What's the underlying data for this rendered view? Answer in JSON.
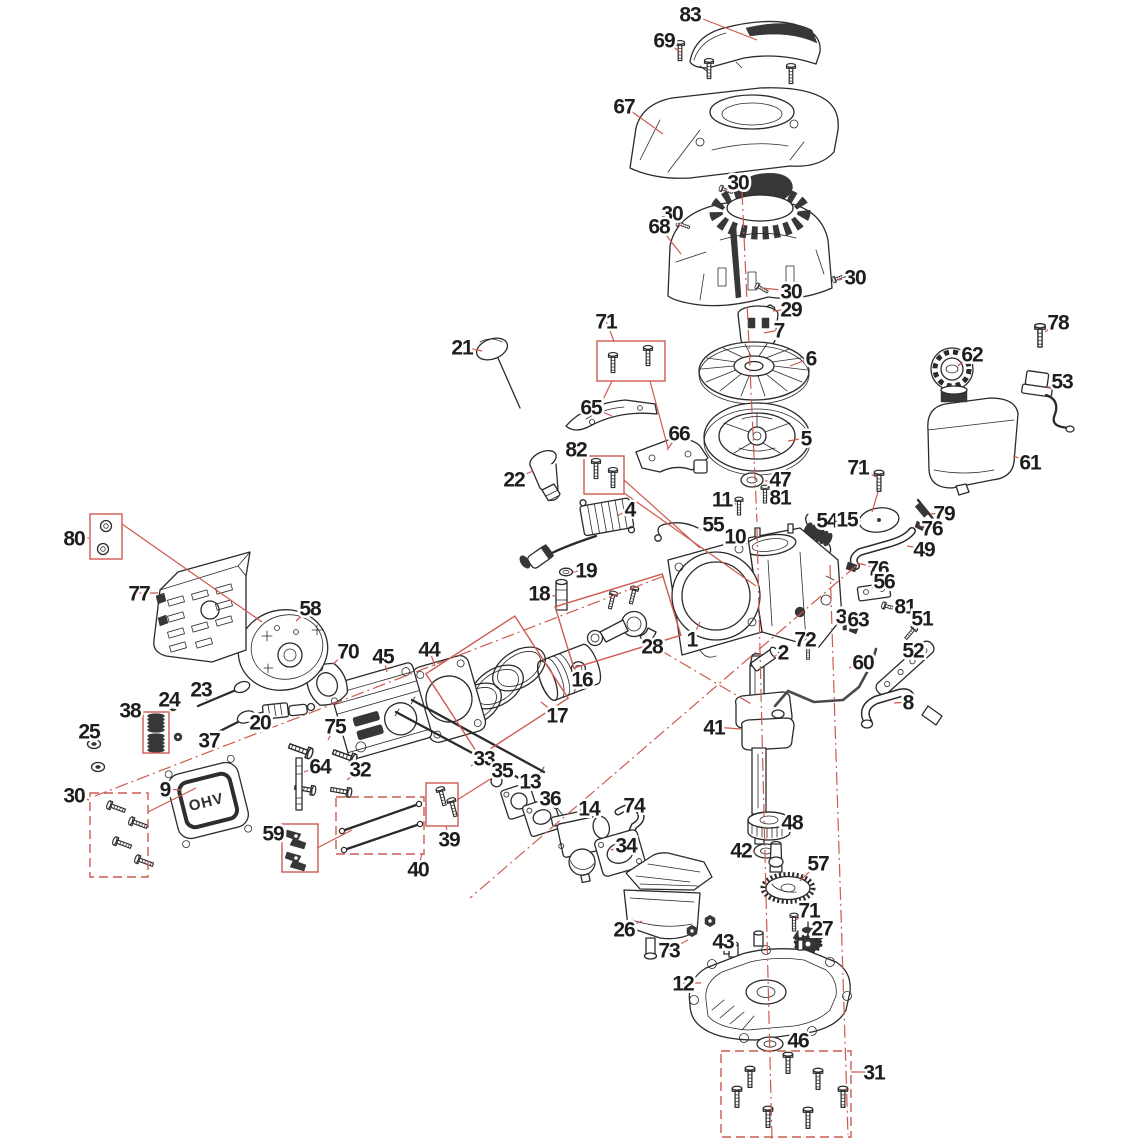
{
  "diagram": {
    "type": "exploded-parts-diagram",
    "subject": "small OHV engine exploded view",
    "background": "#ffffff",
    "colors": {
      "red": "#cd5a50",
      "ink": "#1e1e1e"
    },
    "ohv_label": "OHV",
    "callouts": [
      {
        "n": "83",
        "x": 690,
        "y": 14,
        "tx": 757,
        "ty": 40
      },
      {
        "n": "69",
        "x": 664,
        "y": 40,
        "tx": 680,
        "ty": 52
      },
      {
        "n": "67",
        "x": 624,
        "y": 106,
        "tx": 663,
        "ty": 134
      },
      {
        "n": "30",
        "x": 738,
        "y": 182,
        "tx": 725,
        "ty": 191
      },
      {
        "n": "30",
        "x": 672,
        "y": 213,
        "tx": 680,
        "ty": 226
      },
      {
        "n": "68",
        "x": 659,
        "y": 226,
        "tx": 681,
        "ty": 254
      },
      {
        "n": "30",
        "x": 855,
        "y": 277,
        "tx": 838,
        "ty": 280
      },
      {
        "n": "30",
        "x": 791,
        "y": 291,
        "tx": 762,
        "ty": 288
      },
      {
        "n": "29",
        "x": 791,
        "y": 309,
        "tx": 773,
        "ty": 311
      },
      {
        "n": "71",
        "x": 606,
        "y": 321,
        "tx": 614,
        "ty": 341
      },
      {
        "n": "7",
        "x": 779,
        "y": 330,
        "tx": 764,
        "ty": 333
      },
      {
        "n": "6",
        "x": 811,
        "y": 358,
        "tx": 790,
        "ty": 366
      },
      {
        "n": "78",
        "x": 1058,
        "y": 322,
        "tx": 1045,
        "ty": 332
      },
      {
        "n": "62",
        "x": 972,
        "y": 354,
        "tx": 958,
        "ty": 366
      },
      {
        "n": "53",
        "x": 1062,
        "y": 381,
        "tx": 1047,
        "ty": 388
      },
      {
        "n": "21",
        "x": 462,
        "y": 347,
        "tx": 482,
        "ty": 351
      },
      {
        "n": "65",
        "x": 591,
        "y": 407,
        "tx": 612,
        "ty": 416
      },
      {
        "n": "66",
        "x": 679,
        "y": 433,
        "tx": 667,
        "ty": 450
      },
      {
        "n": "5",
        "x": 806,
        "y": 438,
        "tx": 788,
        "ty": 441
      },
      {
        "n": "61",
        "x": 1030,
        "y": 462,
        "tx": 1013,
        "ty": 456
      },
      {
        "n": "82",
        "x": 576,
        "y": 449,
        "tx": 588,
        "ty": 459
      },
      {
        "n": "22",
        "x": 514,
        "y": 479,
        "tx": 533,
        "ty": 471
      },
      {
        "n": "71",
        "x": 858,
        "y": 467,
        "tx": 876,
        "ty": 477
      },
      {
        "n": "47",
        "x": 780,
        "y": 479,
        "tx": 765,
        "ty": 481
      },
      {
        "n": "81",
        "x": 780,
        "y": 497,
        "tx": 769,
        "ty": 496
      },
      {
        "n": "11",
        "x": 722,
        "y": 499,
        "tx": 736,
        "ty": 504
      },
      {
        "n": "4",
        "x": 630,
        "y": 509,
        "tx": 617,
        "ty": 516
      },
      {
        "n": "55",
        "x": 713,
        "y": 524,
        "tx": 700,
        "ty": 530
      },
      {
        "n": "10",
        "x": 735,
        "y": 536,
        "tx": 747,
        "ty": 544
      },
      {
        "n": "54",
        "x": 827,
        "y": 520,
        "tx": 819,
        "ty": 529
      },
      {
        "n": "15",
        "x": 847,
        "y": 519,
        "tx": 861,
        "ty": 521
      },
      {
        "n": "79",
        "x": 944,
        "y": 513,
        "tx": 930,
        "ty": 514
      },
      {
        "n": "76",
        "x": 932,
        "y": 528,
        "tx": 921,
        "ty": 526
      },
      {
        "n": "49",
        "x": 924,
        "y": 549,
        "tx": 907,
        "ty": 546
      },
      {
        "n": "76",
        "x": 878,
        "y": 568,
        "tx": 857,
        "ty": 563
      },
      {
        "n": "56",
        "x": 884,
        "y": 581,
        "tx": 872,
        "ty": 588
      },
      {
        "n": "80",
        "x": 74,
        "y": 538,
        "tx": 89,
        "ty": 538
      },
      {
        "n": "77",
        "x": 139,
        "y": 593,
        "tx": 158,
        "ty": 593
      },
      {
        "n": "58",
        "x": 310,
        "y": 608,
        "tx": 296,
        "ty": 621
      },
      {
        "n": "70",
        "x": 348,
        "y": 651,
        "tx": 333,
        "ty": 664
      },
      {
        "n": "19",
        "x": 586,
        "y": 570,
        "tx": 573,
        "ty": 572
      },
      {
        "n": "18",
        "x": 539,
        "y": 593,
        "tx": 555,
        "ty": 596
      },
      {
        "n": "28",
        "x": 652,
        "y": 646,
        "tx": 641,
        "ty": 638
      },
      {
        "n": "16",
        "x": 582,
        "y": 679,
        "tx": 572,
        "ty": 671
      },
      {
        "n": "17",
        "x": 557,
        "y": 715,
        "tx": 541,
        "ty": 702
      },
      {
        "n": "45",
        "x": 383,
        "y": 656,
        "tx": 387,
        "ty": 672
      },
      {
        "n": "44",
        "x": 429,
        "y": 649,
        "tx": 435,
        "ty": 666
      },
      {
        "n": "1",
        "x": 692,
        "y": 639,
        "tx": 700,
        "ty": 622
      },
      {
        "n": "81",
        "x": 905,
        "y": 606,
        "tx": 892,
        "ty": 608
      },
      {
        "n": "51",
        "x": 922,
        "y": 618,
        "tx": 913,
        "ty": 628
      },
      {
        "n": "3",
        "x": 841,
        "y": 616,
        "tx": 845,
        "ty": 625
      },
      {
        "n": "63",
        "x": 858,
        "y": 619,
        "tx": 853,
        "ty": 628
      },
      {
        "n": "2",
        "x": 783,
        "y": 652,
        "tx": 773,
        "ty": 657
      },
      {
        "n": "72",
        "x": 805,
        "y": 639,
        "tx": 807,
        "ty": 649
      },
      {
        "n": "60",
        "x": 863,
        "y": 662,
        "tx": 849,
        "ty": 668
      },
      {
        "n": "52",
        "x": 913,
        "y": 650,
        "tx": 903,
        "ty": 658
      },
      {
        "n": "8",
        "x": 908,
        "y": 702,
        "tx": 894,
        "ty": 703
      },
      {
        "n": "41",
        "x": 714,
        "y": 727,
        "tx": 741,
        "ty": 729
      },
      {
        "n": "38",
        "x": 130,
        "y": 710,
        "tx": 144,
        "ty": 716
      },
      {
        "n": "24",
        "x": 169,
        "y": 699,
        "tx": 176,
        "ty": 707
      },
      {
        "n": "23",
        "x": 201,
        "y": 689,
        "tx": 207,
        "ty": 700
      },
      {
        "n": "25",
        "x": 89,
        "y": 731,
        "tx": 93,
        "ty": 741
      },
      {
        "n": "37",
        "x": 209,
        "y": 740,
        "tx": 214,
        "ty": 731
      },
      {
        "n": "20",
        "x": 260,
        "y": 722,
        "tx": 267,
        "ty": 713
      },
      {
        "n": "75",
        "x": 335,
        "y": 726,
        "tx": 328,
        "ty": 740
      },
      {
        "n": "30",
        "x": 74,
        "y": 795,
        "tx": 89,
        "ty": 800
      },
      {
        "n": "9",
        "x": 165,
        "y": 789,
        "tx": 181,
        "ty": 790
      },
      {
        "n": "64",
        "x": 320,
        "y": 766,
        "tx": 304,
        "ty": 772
      },
      {
        "n": "32",
        "x": 360,
        "y": 769,
        "tx": 347,
        "ty": 780
      },
      {
        "n": "59",
        "x": 273,
        "y": 833,
        "tx": 282,
        "ty": 840
      },
      {
        "n": "33",
        "x": 484,
        "y": 758,
        "tx": 471,
        "ty": 766
      },
      {
        "n": "35",
        "x": 502,
        "y": 770,
        "tx": 497,
        "ty": 778
      },
      {
        "n": "13",
        "x": 530,
        "y": 781,
        "tx": 519,
        "ty": 789
      },
      {
        "n": "36",
        "x": 550,
        "y": 798,
        "tx": 539,
        "ty": 805
      },
      {
        "n": "14",
        "x": 589,
        "y": 808,
        "tx": 579,
        "ty": 817
      },
      {
        "n": "74",
        "x": 634,
        "y": 805,
        "tx": 624,
        "ty": 810
      },
      {
        "n": "34",
        "x": 626,
        "y": 845,
        "tx": 611,
        "ty": 850
      },
      {
        "n": "39",
        "x": 449,
        "y": 839,
        "tx": 446,
        "ty": 826
      },
      {
        "n": "40",
        "x": 418,
        "y": 869,
        "tx": 422,
        "ty": 854
      },
      {
        "n": "48",
        "x": 792,
        "y": 822,
        "tx": 779,
        "ty": 824
      },
      {
        "n": "42",
        "x": 741,
        "y": 850,
        "tx": 755,
        "ty": 851
      },
      {
        "n": "57",
        "x": 818,
        "y": 863,
        "tx": 800,
        "ty": 881
      },
      {
        "n": "71",
        "x": 809,
        "y": 910,
        "tx": 796,
        "ty": 920
      },
      {
        "n": "27",
        "x": 822,
        "y": 928,
        "tx": 813,
        "ty": 936
      },
      {
        "n": "26",
        "x": 624,
        "y": 929,
        "tx": 642,
        "ty": 921
      },
      {
        "n": "43",
        "x": 723,
        "y": 941,
        "tx": 734,
        "ty": 948
      },
      {
        "n": "73",
        "x": 669,
        "y": 950,
        "tx": 688,
        "ty": 940
      },
      {
        "n": "12",
        "x": 683,
        "y": 983,
        "tx": 701,
        "ty": 983
      },
      {
        "n": "46",
        "x": 798,
        "y": 1040,
        "tx": 785,
        "ty": 1043
      },
      {
        "n": "31",
        "x": 874,
        "y": 1072,
        "tx": 851,
        "ty": 1072
      }
    ],
    "boxes": [
      {
        "label": "71",
        "x": 597,
        "y": 341,
        "w": 68,
        "h": 40,
        "dashed": false
      },
      {
        "label": "82",
        "x": 584,
        "y": 456,
        "w": 40,
        "h": 38,
        "dashed": false
      },
      {
        "label": "80",
        "x": 90,
        "y": 514,
        "w": 32,
        "h": 45,
        "dashed": false
      },
      {
        "label": "38",
        "x": 143,
        "y": 712,
        "w": 26,
        "h": 41,
        "dashed": false
      },
      {
        "label": "30",
        "x": 90,
        "y": 793,
        "w": 58,
        "h": 84,
        "dashed": true
      },
      {
        "label": "59",
        "x": 282,
        "y": 824,
        "w": 36,
        "h": 48,
        "dashed": false
      },
      {
        "label": "40",
        "x": 336,
        "y": 797,
        "w": 88,
        "h": 57,
        "dashed": true
      },
      {
        "label": "39",
        "x": 426,
        "y": 783,
        "w": 32,
        "h": 43,
        "dashed": false
      },
      {
        "label": "31",
        "x": 721,
        "y": 1051,
        "w": 130,
        "h": 86,
        "dashed": true
      },
      {
        "label": "28",
        "cx": 618,
        "cy": 621,
        "w": 112,
        "h": 64,
        "rot": -17,
        "dashed": false
      },
      {
        "label": "17",
        "cx": 497,
        "cy": 686,
        "w": 106,
        "h": 98,
        "rot": -33,
        "dashed": false
      }
    ]
  }
}
